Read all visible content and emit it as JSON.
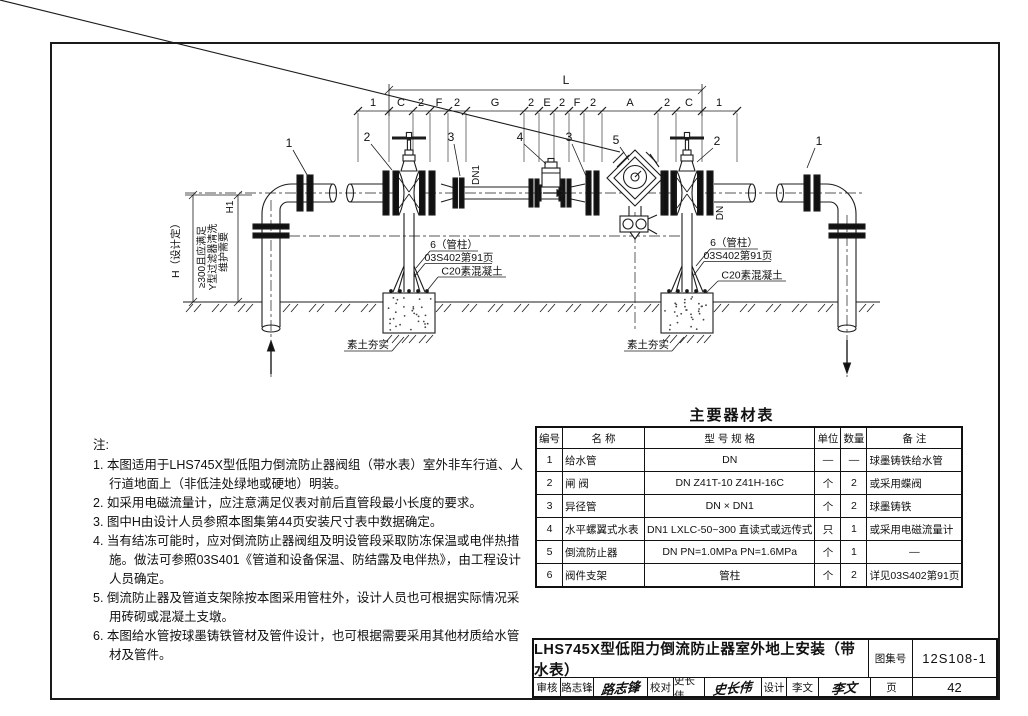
{
  "diagram": {
    "overall_dim": "L",
    "segments": [
      "1",
      "C",
      "2",
      "F",
      "2",
      "G",
      "2",
      "E",
      "2",
      "F",
      "2",
      "A",
      "2",
      "C",
      "1"
    ],
    "callouts": [
      "1",
      "2",
      "3",
      "4",
      "3",
      "5",
      "2",
      "1"
    ],
    "left_dims": {
      "h": "H（设计定）",
      "h1": "H1",
      "notes": [
        "≥300且应满足",
        "Y型过滤器清洗",
        "维护需要"
      ]
    },
    "pipe_labels": {
      "dn1": "DN1",
      "dn": "DN"
    },
    "support_note": [
      "6（管柱）",
      "03S402第91页",
      "C20素混凝土"
    ],
    "soil_note": "素土夯实"
  },
  "notes": {
    "title": "注:",
    "items": [
      "1. 本图适用于LHS745X型低阻力倒流防止器阀组（带水表）室外非车行道、人行道地面上（非低洼处绿地或硬地）明装。",
      "2. 如采用电磁流量计，应注意满足仪表对前后直管段最小长度的要求。",
      "3. 图中H由设计人员参照本图集第44页安装尺寸表中数据确定。",
      "4. 当有结冻可能时，应对倒流防止器阀组及明设管段采取防冻保温或电伴热措施。做法可参照03S401《管道和设备保温、防结露及电伴热》，由工程设计人员确定。",
      "5. 倒流防止器及管道支架除按本图采用管柱外，设计人员也可根据实际情况采用砖砌或混凝土支墩。",
      "6. 本图给水管按球墨铸铁管材及管件设计，也可根据需要采用其他材质给水管材及管件。"
    ]
  },
  "table": {
    "title": "主要器材表",
    "headers": [
      "编号",
      "名  称",
      "型 号 规 格",
      "单位",
      "数量",
      "备  注"
    ],
    "rows": [
      [
        "1",
        "给水管",
        "DN",
        "—",
        "—",
        "球墨铸铁给水管"
      ],
      [
        "2",
        "闸 阀",
        "DN  Z41T-10  Z41H-16C",
        "个",
        "2",
        "或采用蝶阀"
      ],
      [
        "3",
        "异径管",
        "DN × DN1",
        "个",
        "2",
        "球墨铸铁"
      ],
      [
        "4",
        "水平螺翼式水表",
        "DN1 LXLC-50~300 直读式或远传式",
        "只",
        "1",
        "或采用电磁流量计"
      ],
      [
        "5",
        "倒流防止器",
        "DN  PN=1.0MPa  PN=1.6MPa",
        "个",
        "1",
        "—"
      ],
      [
        "6",
        "阀件支架",
        "管柱",
        "个",
        "2",
        "详见03S402第91页"
      ]
    ]
  },
  "title_block": {
    "title": "LHS745X型低阻力倒流防止器室外地上安装（带水表）",
    "atlas_label": "图集号",
    "atlas_no": "12S108-1",
    "page_label": "页",
    "page_no": "42",
    "roles": [
      {
        "role": "审核",
        "name": "路志锋",
        "signature": "路志锋"
      },
      {
        "role": "校对",
        "name": "史长伟",
        "signature": "史长伟"
      },
      {
        "role": "设计",
        "name": "李文",
        "signature": "李文"
      }
    ]
  }
}
